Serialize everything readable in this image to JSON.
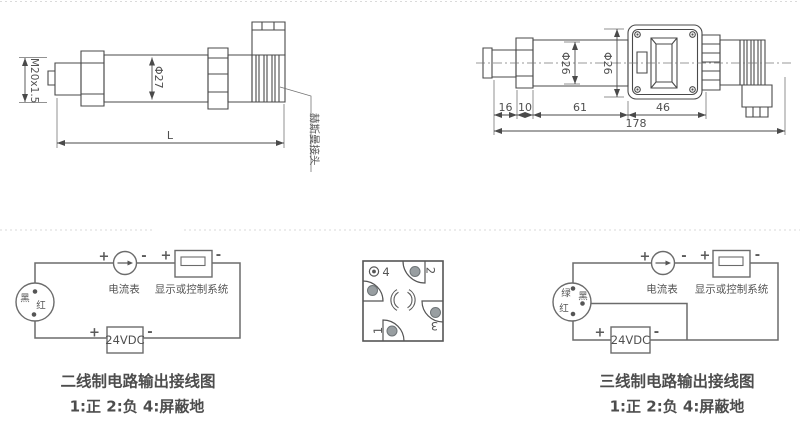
{
  "top_left": {
    "thread": "M20x1.5",
    "diameter": "Φ27",
    "length": "L",
    "connector": "赫斯曼接头"
  },
  "top_right": {
    "d1": "Φ26",
    "d2": "Φ26",
    "seg16": "16",
    "seg10": "10",
    "seg61": "61",
    "seg46": "46",
    "total": "178"
  },
  "pinout": {
    "p1": "1",
    "p2": "2",
    "p3": "3",
    "p4": "4"
  },
  "two_wire": {
    "wire_black": "黑",
    "wire_red": "红",
    "plus": "+",
    "minus": "-",
    "ammeter": "电流表",
    "display": "显示或控制系统",
    "power": "24VDC",
    "caption": "二线制电路输出接线图",
    "legend": "1:正 2:负 4:屏蔽地"
  },
  "three_wire": {
    "wire_green": "绿",
    "wire_black": "黑",
    "wire_red": "红",
    "plus": "+",
    "minus": "-",
    "ammeter": "电流表",
    "display": "显示或控制系统",
    "power": "24VDC",
    "caption": "三线制电路输出接线图",
    "legend": "1:正 2:负 4:屏蔽地"
  },
  "colors": {
    "line": "#4a4a4a",
    "wire": "#6b6b6b",
    "pin_fill": "#989ea1",
    "divider": "#dadada"
  }
}
